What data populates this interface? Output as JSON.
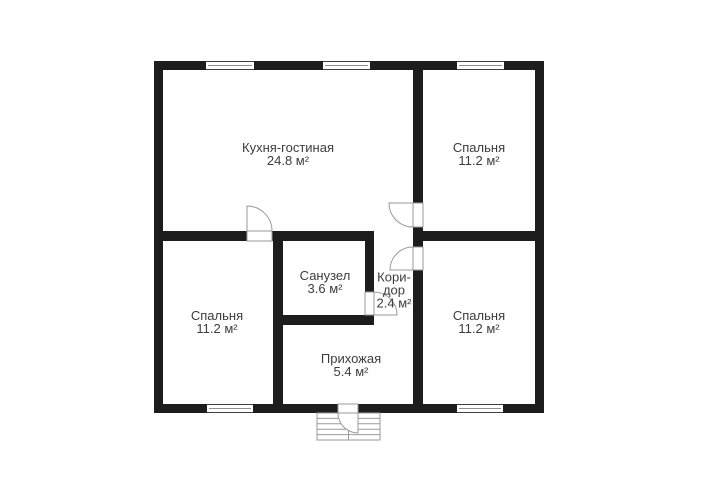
{
  "rooms": {
    "kitchen_living": {
      "name": "Кухня-гостиная",
      "area": "24.8 м²"
    },
    "bedroom_top_right": {
      "name": "Спальня",
      "area": "11.2 м²"
    },
    "bathroom": {
      "name": "Санузел",
      "area": "3.6 м²"
    },
    "corridor": {
      "name_line_1": "Кори-",
      "name_line_2": "дор",
      "area": "2.4 м²"
    },
    "bedroom_bottom_left": {
      "name": "Спальня",
      "area": "11.2 м²"
    },
    "bedroom_bottom_right": {
      "name": "Спальня",
      "area": "11.2 м²"
    },
    "hallway": {
      "name": "Прихожая",
      "area": "5.4 м²"
    }
  },
  "colors": {
    "wall": "#1d1d1d",
    "text": "#3d3d3d",
    "symbol_line": "#9a9a9a",
    "background": "#ffffff"
  }
}
